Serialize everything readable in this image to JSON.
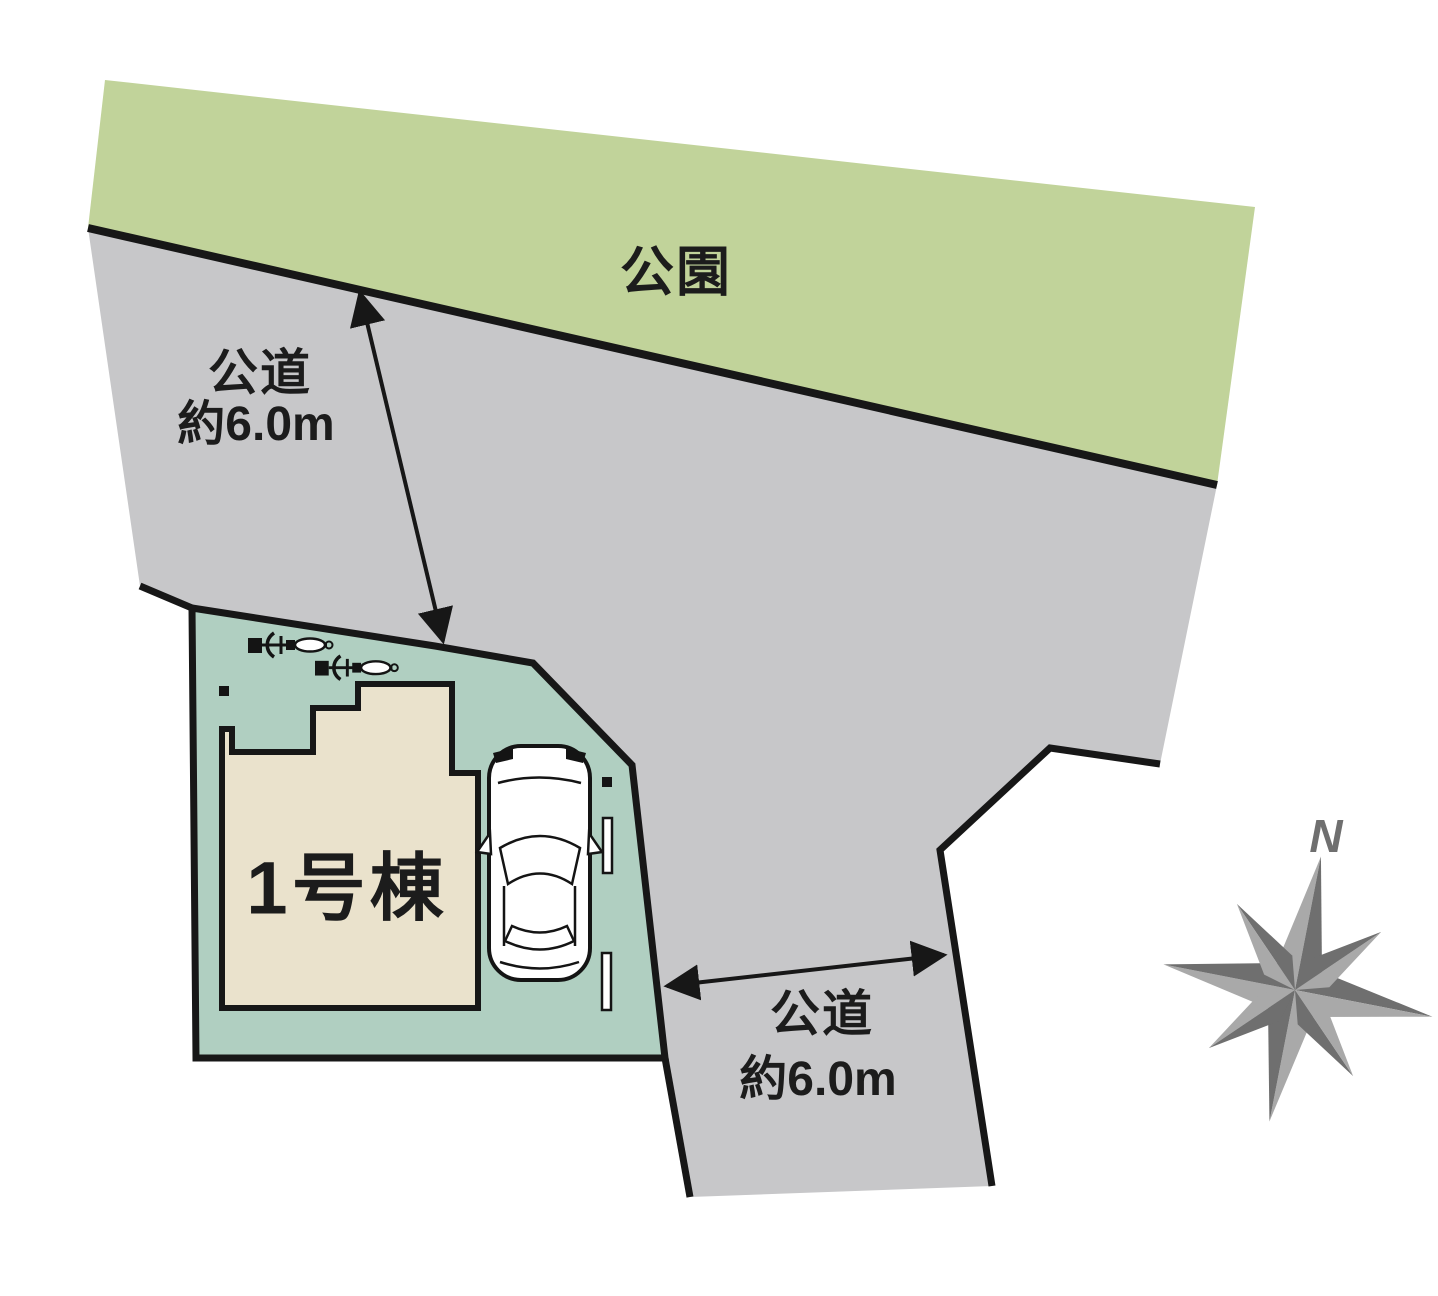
{
  "diagram": {
    "park": {
      "label": "公園"
    },
    "road_north": {
      "name": "公道",
      "width": "約6.0m"
    },
    "road_east": {
      "name": "公道",
      "width": "約6.0m"
    },
    "building": {
      "label": "1号棟"
    },
    "compass": {
      "north": "N"
    }
  },
  "colors": {
    "park": "#c1d39a",
    "road": "#c7c7c9",
    "lot": "#b0cfc1",
    "building": "#eae2cc",
    "outline": "#171717",
    "compass_dark": "#6f6f6f",
    "compass_light": "#a9a9a9",
    "text": "#1c1c1c"
  }
}
